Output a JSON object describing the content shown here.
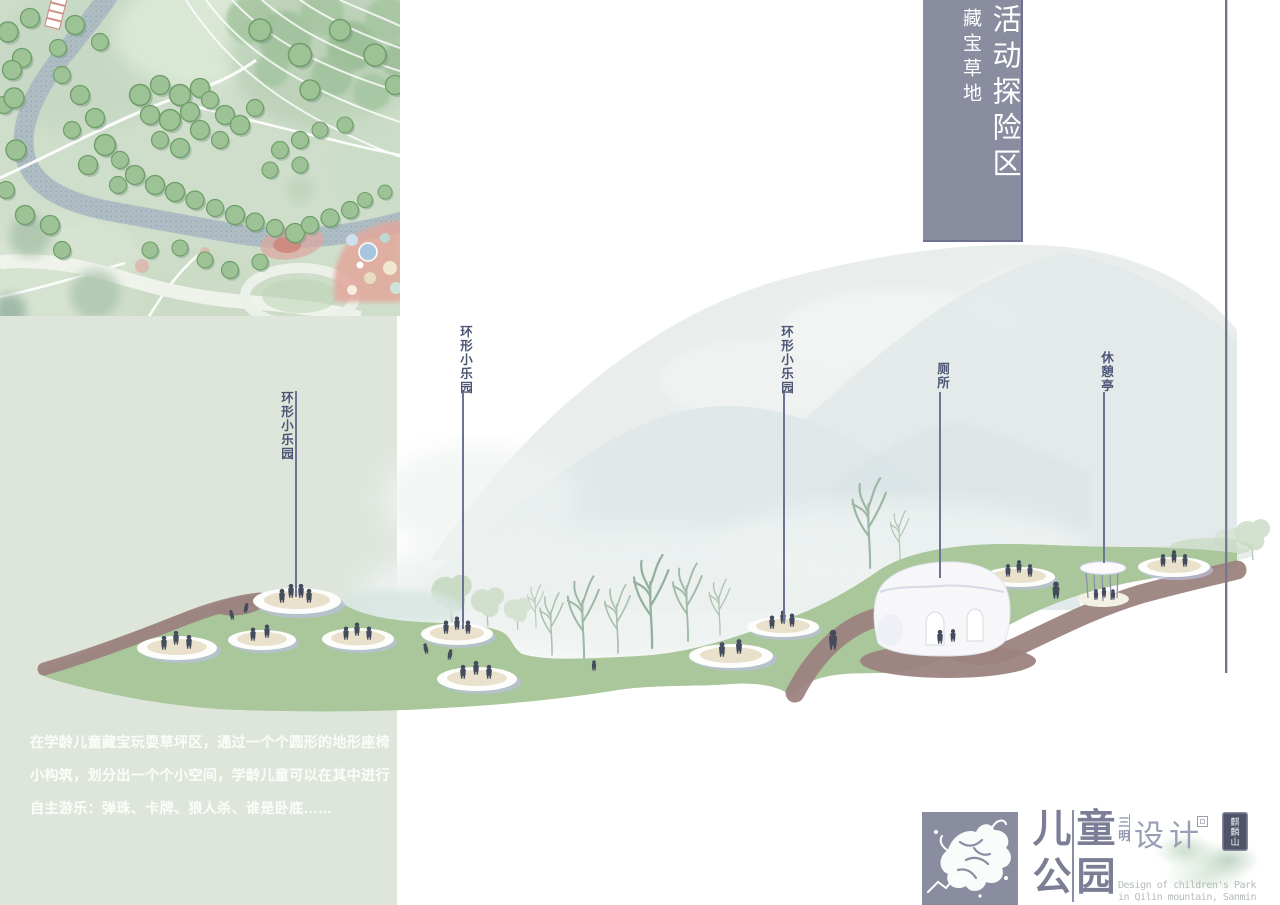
{
  "banner": {
    "title": "活动探险区",
    "subtitle": "藏宝草地"
  },
  "labels": {
    "ring1": "环形小乐园",
    "ring2": "环形小乐园",
    "ring3": "环形小乐园",
    "toilet": "厕所",
    "pavilion": "休憩亭"
  },
  "description": "在学龄儿童藏宝玩耍草坪区，通过一个个圆形的地形座椅小构筑，划分出一个个小空间，学龄儿童可以在其中进行自主游乐：弹珠、卡牌、狼人杀、谁是卧底……",
  "footer": {
    "title_chars": [
      "儿",
      "童",
      "公",
      "园"
    ],
    "region": "三明",
    "design": "设计",
    "seal": "麒麟山",
    "english_line1": "Design of children's Park",
    "english_line2": "in Qilin mountain, Sanmin"
  },
  "colors": {
    "banner_bg": "#8a8da0",
    "panel_bg": "#dee6dc",
    "lawn_green": "#a9c79b",
    "path_brown": "#9c837f",
    "title_ink": "#7b7e95",
    "label_ink": "#4d5575"
  }
}
